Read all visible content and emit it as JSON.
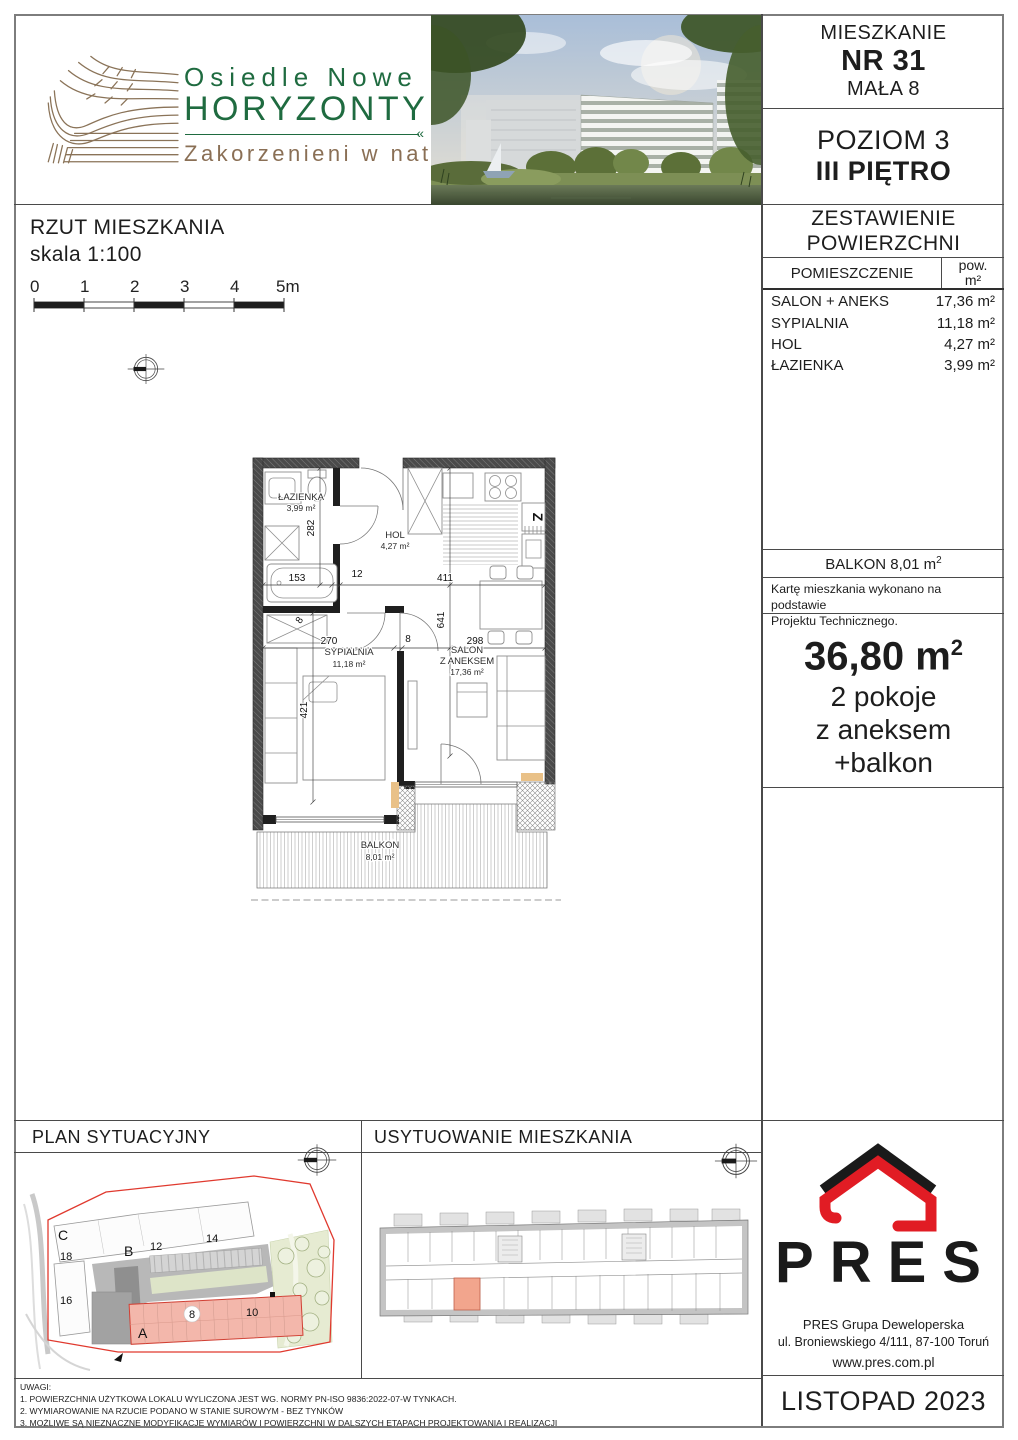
{
  "brand": {
    "name_line1": "Osiedle Nowe",
    "name_line2": "HORYZONTY",
    "tagline": "Zakorzenieni w naturze"
  },
  "title_block": {
    "apartment_label": "MIESZKANIE",
    "apartment_no": "NR 31",
    "building": "MAŁA 8",
    "level_line1": "POZIOM 3",
    "level_line2": "III PIĘTRO",
    "areas_title_line1": "ZESTAWIENIE",
    "areas_title_line2": "POWIERZCHNI"
  },
  "area_table": {
    "col_room": "POMIESZCZENIE",
    "col_area_line1": "pow.",
    "col_area_line2": "m²",
    "rows": [
      {
        "name": "SALON + ANEKS",
        "area": "17,36 m²"
      },
      {
        "name": "SYPIALNIA",
        "area": "11,18 m²"
      },
      {
        "name": "HOL",
        "area": "4,27 m²"
      },
      {
        "name": "ŁAZIENKA",
        "area": "3,99 m²"
      }
    ],
    "balcony_label": "BALKON 8,01 m",
    "balcony_sup": "2",
    "note_line1": "Kartę mieszkania wykonano na podstawie",
    "note_line2": "Projektu Technicznego.",
    "total_area": "36,80 m",
    "total_sup": "2",
    "summary": [
      "2 pokoje",
      "z aneksem",
      "+balkon"
    ]
  },
  "plan": {
    "title": "RZUT MIESZKANIA",
    "scale": "skala 1:100",
    "ticks": [
      "0",
      "1",
      "2",
      "3",
      "4",
      "5m"
    ],
    "rooms": {
      "bathroom_name": "ŁAZIENKA",
      "bathroom_area": "3,99 m²",
      "hall_name": "HOL",
      "hall_area": "4,27 m²",
      "bedroom_name": "SYPIALNIA",
      "bedroom_area": "11,18 m²",
      "living_name1": "SALON",
      "living_name2": "Z ANEKSEM",
      "living_area": "17,36 m²",
      "balcony_name": "BALKON",
      "balcony_area": "8,01 m²",
      "kitchen_mark": "Z"
    },
    "dims": {
      "d282": "282",
      "d153": "153",
      "d12": "12",
      "d411": "411",
      "d8a": "8",
      "d270": "270",
      "d8b": "8",
      "d298": "298",
      "d641": "641",
      "d421": "421"
    }
  },
  "site": {
    "title": "PLAN SYTUACYJNY",
    "labels": {
      "a": "A",
      "b": "B",
      "c": "C",
      "n8": "8",
      "n10": "10",
      "n12": "12",
      "n14": "14",
      "n16": "16",
      "n18": "18"
    }
  },
  "location": {
    "title": "USYTUOWANIE MIESZKANIA"
  },
  "developer": {
    "logo_text": "PRES",
    "line1": "PRES Grupa Deweloperska",
    "line2": "ul. Broniewskiego 4/111, 87-100 Toruń",
    "website": "www.pres.com.pl",
    "date": "LISTOPAD 2023"
  },
  "notes": {
    "title": "UWAGI:",
    "items": [
      "1. POWIERZCHNIA UŻYTKOWA LOKALU WYLICZONA JEST WG. NORMY PN-ISO 9836:2022-07-W TYNKACH.",
      "2. WYMIAROWANIE NA RZUCIE PODANO W STANIE SUROWYM - BEZ TYNKÓW",
      "3. MOŻLIWE SĄ NIEZNACZNE MODYFIKACJE WYMIARÓW I POWIERZCHNI W DALSZYCH ETAPACH PROJEKTOWANIA I REALIZACJI"
    ]
  },
  "colors": {
    "brand_green": "#1f6b40",
    "brand_brown": "#8a6f55",
    "accent_red": "#e11c24",
    "highlight_pink": "#f3b7ab",
    "highlight_salmon": "#f2a58d"
  }
}
